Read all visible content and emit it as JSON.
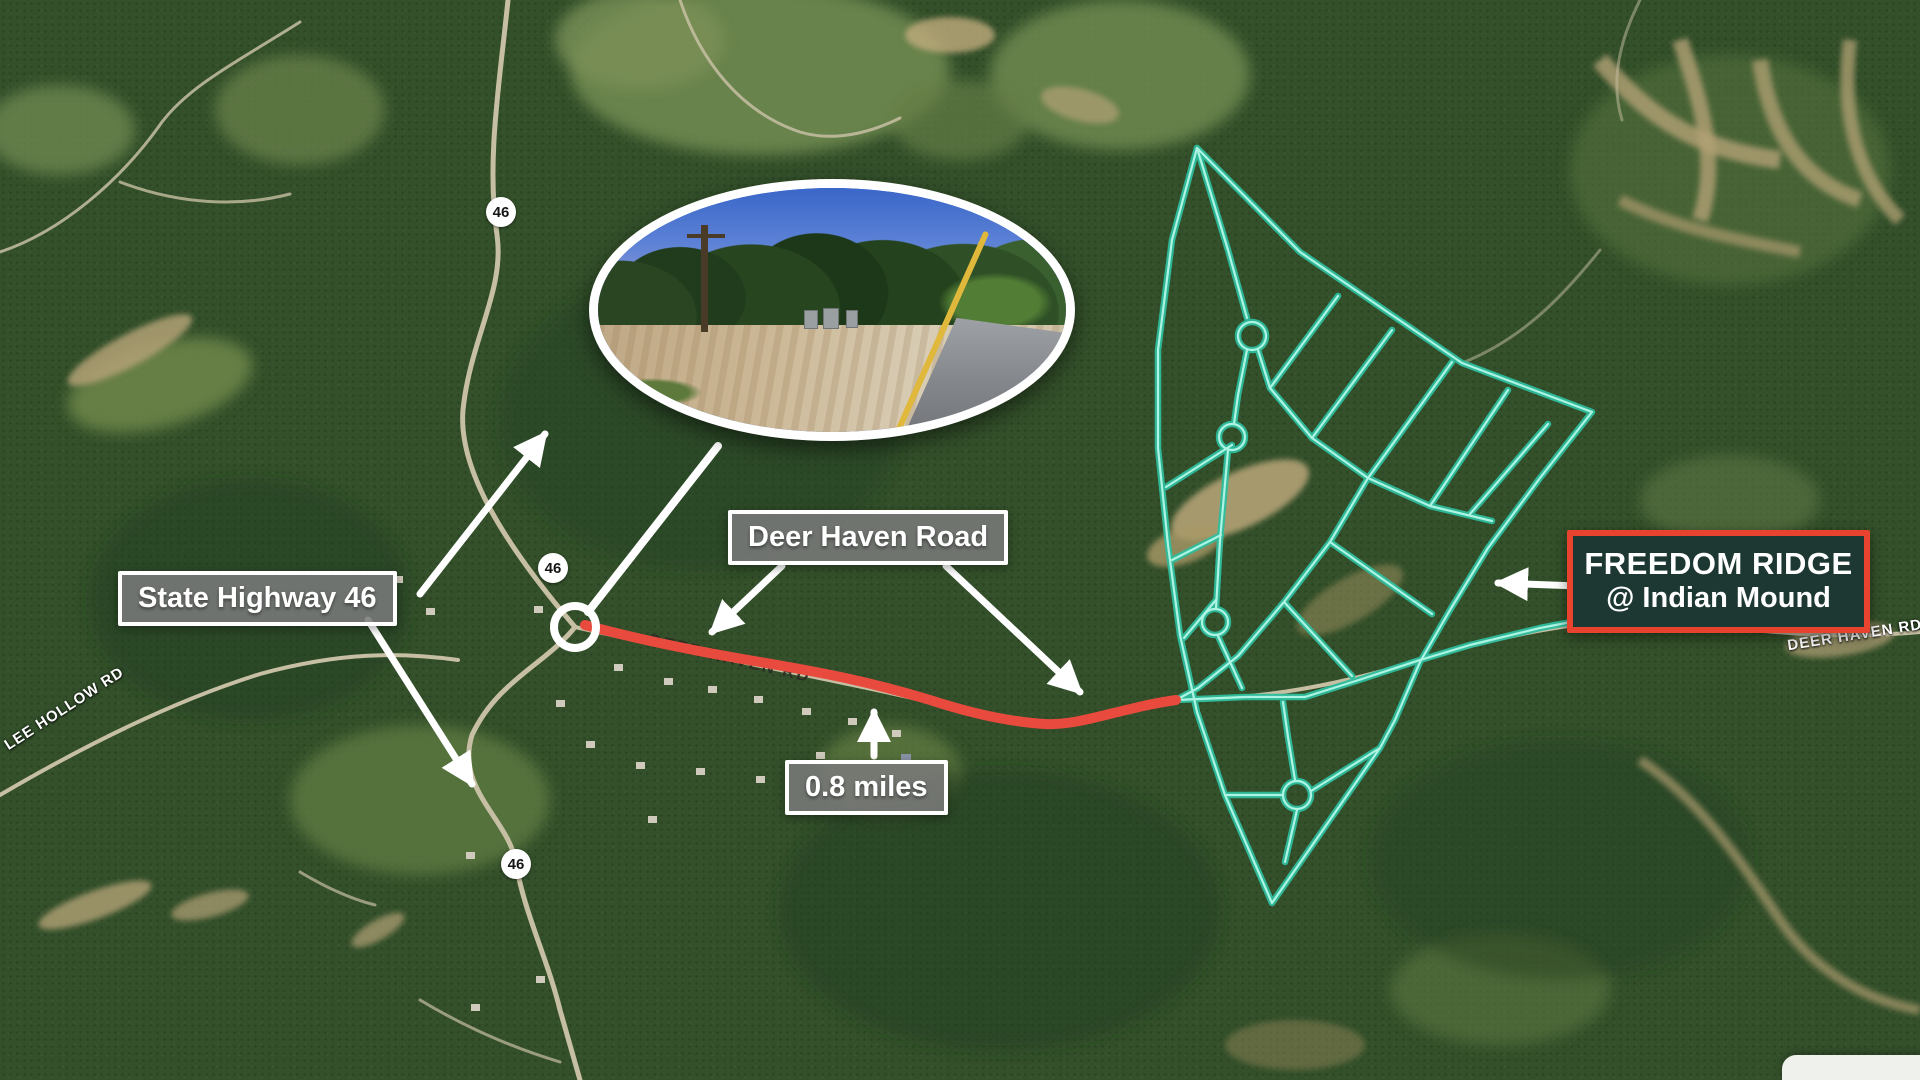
{
  "map": {
    "shield": "46",
    "callouts": {
      "state_highway": "State Highway 46",
      "deer_haven_road": "Deer Haven Road",
      "distance": "0.8 miles"
    },
    "destination": {
      "line1": "FREEDOM RIDGE",
      "line2": "@ Indian Mound"
    },
    "road_labels": {
      "lee_hollow": "LEE HOLLOW RD",
      "deer_haven_on_road": "DEER HAVEN RD",
      "deer_haven_east": "DEER HAVEN RD"
    },
    "colors": {
      "plat_line": "#2fbd9d",
      "plat_line_core": "#aef4e2",
      "route_highlight": "#e84a3d",
      "destination_bg": "#1d3833",
      "destination_border": "#e8432e",
      "callout_bg": "#7a7a7a",
      "callout_border": "#ffffff"
    }
  }
}
